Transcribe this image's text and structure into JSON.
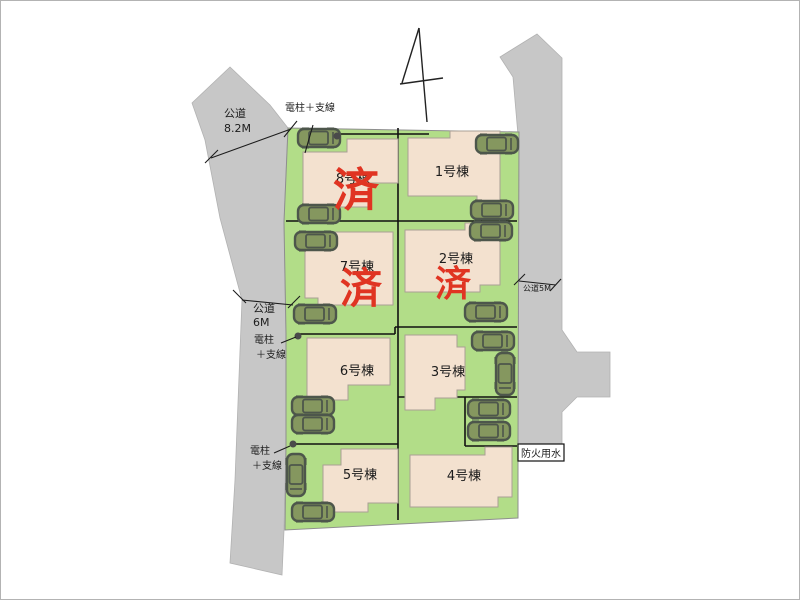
{
  "plan": {
    "type": "residential-subdivision-site-plan",
    "sold_stamp_text": "済",
    "colors": {
      "green_lot": "#b2dd88",
      "road_gray": "#c7c7c7",
      "building_beige": "#f3e1cf",
      "stamp_red": "#e03422",
      "car_body": "#85975f",
      "car_outline": "#4d564b",
      "line_black": "#111111"
    },
    "lots": [
      {
        "id": 1,
        "label": "1号棟",
        "sold": false,
        "label_x": 452,
        "label_y": 176
      },
      {
        "id": 2,
        "label": "2号棟",
        "sold": true,
        "label_x": 456,
        "label_y": 263,
        "stamp_x": 453,
        "stamp_y": 296,
        "stamp_size": 36
      },
      {
        "id": 3,
        "label": "3号棟",
        "sold": false,
        "label_x": 448,
        "label_y": 376
      },
      {
        "id": 4,
        "label": "4号棟",
        "sold": false,
        "label_x": 464,
        "label_y": 480
      },
      {
        "id": 5,
        "label": "5号棟",
        "sold": false,
        "label_x": 360,
        "label_y": 479
      },
      {
        "id": 6,
        "label": "6号棟",
        "sold": false,
        "label_x": 357,
        "label_y": 375
      },
      {
        "id": 7,
        "label": "7号棟",
        "sold": true,
        "label_x": 357,
        "label_y": 271,
        "stamp_x": 361,
        "stamp_y": 303,
        "stamp_size": 42
      },
      {
        "id": 8,
        "label": "8号棟",
        "sold": true,
        "label_x": 353,
        "label_y": 183,
        "stamp_x": 356,
        "stamp_y": 206,
        "stamp_size": 46
      }
    ],
    "cars": [
      {
        "x": 319,
        "y": 138,
        "dir": "h"
      },
      {
        "x": 319,
        "y": 214,
        "dir": "h"
      },
      {
        "x": 497,
        "y": 144,
        "dir": "h"
      },
      {
        "x": 492,
        "y": 210,
        "dir": "h"
      },
      {
        "x": 316,
        "y": 241,
        "dir": "h"
      },
      {
        "x": 315,
        "y": 314,
        "dir": "h"
      },
      {
        "x": 491,
        "y": 231,
        "dir": "h"
      },
      {
        "x": 486,
        "y": 312,
        "dir": "h"
      },
      {
        "x": 493,
        "y": 341,
        "dir": "h"
      },
      {
        "x": 505,
        "y": 374,
        "dir": "v"
      },
      {
        "x": 313,
        "y": 406,
        "dir": "h"
      },
      {
        "x": 313,
        "y": 424,
        "dir": "h"
      },
      {
        "x": 489,
        "y": 409,
        "dir": "h"
      },
      {
        "x": 489,
        "y": 431,
        "dir": "h"
      },
      {
        "x": 296,
        "y": 475,
        "dir": "v"
      },
      {
        "x": 313,
        "y": 512,
        "dir": "h"
      }
    ],
    "annotations": {
      "road_west": {
        "line1": "公道",
        "line2": "8.2M"
      },
      "road_west_lower": {
        "line1": "公道",
        "line2": "6M"
      },
      "road_east": "公道5M",
      "fire_water": "防火用水",
      "pole_top": "電柱＋支線",
      "pole_mid": {
        "line1": "電柱",
        "line2": "＋支線"
      },
      "pole_bottom": {
        "line1": "電柱",
        "line2": "＋支線"
      }
    }
  }
}
